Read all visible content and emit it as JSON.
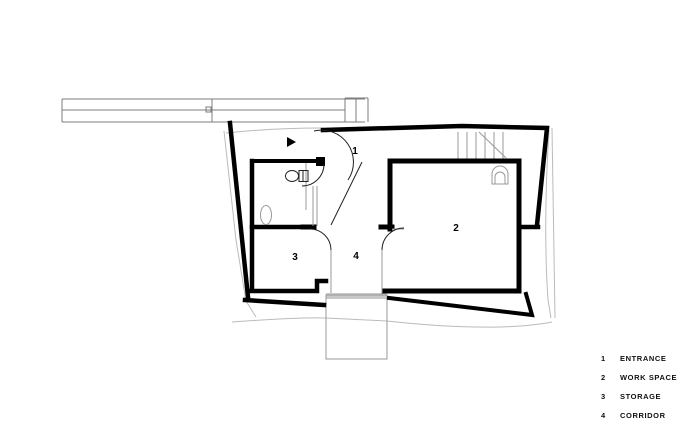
{
  "drawing": {
    "type": "architectural floor plan",
    "rooms": [
      {
        "num": "1",
        "name": "ENTRANCE"
      },
      {
        "num": "2",
        "name": "WORK SPACE"
      },
      {
        "num": "3",
        "name": "STORAGE"
      },
      {
        "num": "4",
        "name": "CORRIDOR"
      }
    ]
  },
  "legend": {
    "items": [
      {
        "num": "1",
        "label": "ENTRANCE"
      },
      {
        "num": "2",
        "label": "WORK SPACE"
      },
      {
        "num": "3",
        "label": "STORAGE"
      },
      {
        "num": "4",
        "label": "CORRIDOR"
      }
    ]
  },
  "colors": {
    "wall": "#000000",
    "fixture": "#222222",
    "interior_line": "#999999",
    "site_line": "#bbbbbb",
    "background": "#ffffff"
  }
}
